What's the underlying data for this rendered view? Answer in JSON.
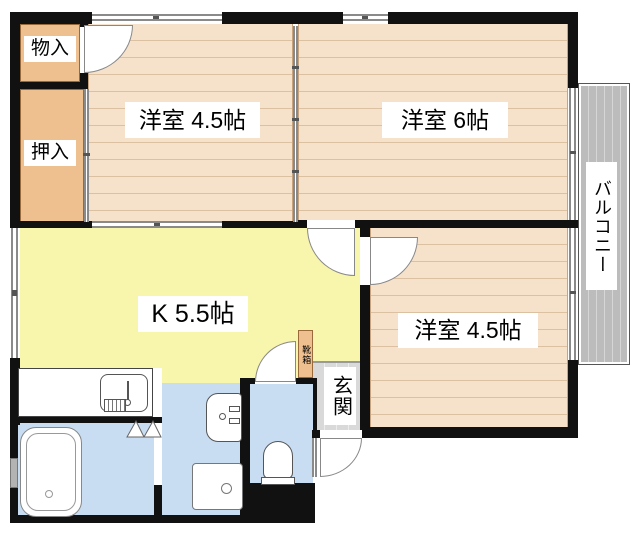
{
  "floorplan": {
    "labels": {
      "room_top_left": "洋室 4.5帖",
      "room_top_right": "洋室 6帖",
      "room_bottom_right": "洋室 4.5帖",
      "kitchen": "K 5.5帖",
      "storage": "物入",
      "closet": "押入",
      "entrance": "玄関",
      "shoe_box": "靴箱",
      "balcony": "バルコニー"
    },
    "fixtures": [
      "kitchen-sink",
      "bathtub",
      "washbasin",
      "washing-machine-pan",
      "toilet",
      "shoe-box"
    ],
    "colors": {
      "wall": "#111111",
      "wood_floor": "#f6e2cb",
      "plank_line": "#dcc0a2",
      "closet_fill": "#eec08f",
      "kitchen_fill": "#f8f6ad",
      "wet_area_fill": "#c8dcf2",
      "balcony_fill": "#bcbcbc",
      "entrance_tile": "#d9d9d9"
    }
  }
}
